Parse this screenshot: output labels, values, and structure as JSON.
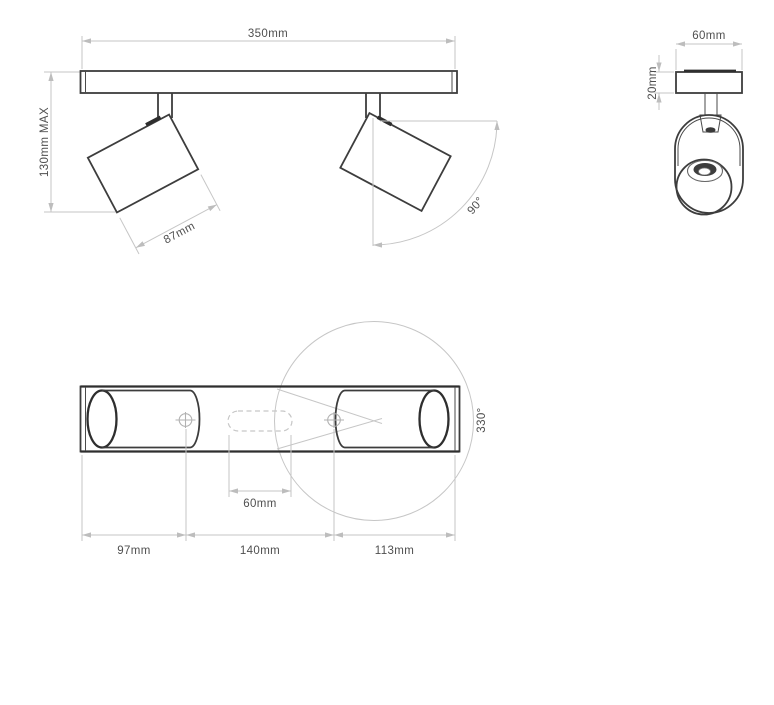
{
  "drawing": {
    "product": "twin-spotlight-ceiling-bar-dimension-diagram",
    "front_view": {
      "bar_width_label": "350mm",
      "max_height_label": "130mm MAX",
      "head_length_label": "87mm",
      "tilt_angle_label": "90°"
    },
    "side_view": {
      "bracket_width_label": "60mm",
      "bracket_thickness_label": "20mm"
    },
    "bottom_view": {
      "left_section_label": "97mm",
      "center_section_label": "140mm",
      "right_section_label": "113mm",
      "slot_width_label": "60mm",
      "rotation_angle_label": "330°"
    },
    "colors": {
      "object_line": "#3d3d3d",
      "bold_line": "#2e2e2e",
      "dimension_line": "#c6c6c6",
      "text": "#4f4f4f",
      "background": "#ffffff"
    }
  }
}
